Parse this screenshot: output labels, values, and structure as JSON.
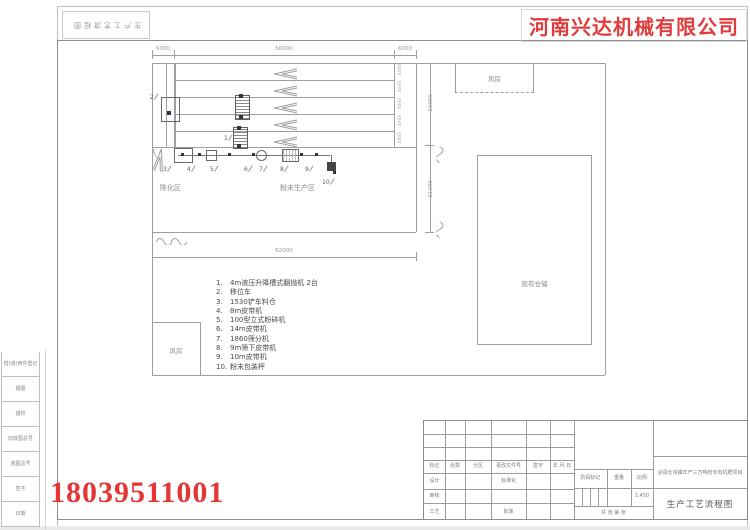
{
  "company": {
    "name": "河南兴达机械有限公司",
    "accent_color": "#e23b3b"
  },
  "watermark_phone": "18039511001",
  "top_stamp": "生产工艺流程图",
  "margin_labels": [
    "借(通)用件登记",
    "描图",
    "描校",
    "旧底图总号",
    "底图总号",
    "签字",
    "日期"
  ],
  "plan": {
    "dims": {
      "top_left": "6000",
      "top_mid": "50000",
      "top_right": "6000",
      "total_width": "62000",
      "right_upper": "21000",
      "right_lower": "21000",
      "lane": "4000"
    },
    "areas": {
      "aging": "陈化区",
      "powder": "粉末生产区",
      "fan_top": "风房",
      "fan_left": "风房",
      "storage": "现有仓储"
    },
    "lanes": [
      {
        "y": 65
      },
      {
        "y": 82
      },
      {
        "y": 99
      },
      {
        "y": 116
      },
      {
        "y": 133
      }
    ],
    "lane_dims": [
      {
        "y": 63,
        "label": "4000"
      },
      {
        "y": 80,
        "label": "4000"
      },
      {
        "y": 97,
        "label": "4000"
      },
      {
        "y": 114,
        "label": "4000"
      },
      {
        "y": 131,
        "label": "4000"
      }
    ],
    "callouts": [
      {
        "n": "1",
        "x": 224,
        "y": 135
      },
      {
        "n": "2",
        "x": 150,
        "y": 94
      },
      {
        "n": "3",
        "x": 163,
        "y": 166
      },
      {
        "n": "4",
        "x": 187,
        "y": 166
      },
      {
        "n": "5",
        "x": 210,
        "y": 166
      },
      {
        "n": "6",
        "x": 244,
        "y": 166
      },
      {
        "n": "7",
        "x": 259,
        "y": 166
      },
      {
        "n": "8",
        "x": 280,
        "y": 166
      },
      {
        "n": "9",
        "x": 305,
        "y": 166
      },
      {
        "n": "10",
        "x": 322,
        "y": 179
      }
    ]
  },
  "parts_list": [
    {
      "no": "1.",
      "text": "4m液压升降槽式翻抛机  2台"
    },
    {
      "no": "2.",
      "text": "移位车"
    },
    {
      "no": "3.",
      "text": "1530铲车料仓"
    },
    {
      "no": "4.",
      "text": "8m皮带机"
    },
    {
      "no": "5.",
      "text": "100型立式粉碎机"
    },
    {
      "no": "6.",
      "text": "14m皮带机"
    },
    {
      "no": "7.",
      "text": "1860筛分机"
    },
    {
      "no": "8.",
      "text": "9m筛下皮带机"
    },
    {
      "no": "9.",
      "text": "10m皮带机"
    },
    {
      "no": "10.",
      "text": "粉末包装秤"
    }
  ],
  "title_block": {
    "header_cells": [
      "标记",
      "处数",
      "分区",
      "更改文件号",
      "签字",
      "年.月.日"
    ],
    "design": "设计",
    "standardization": "标准化",
    "review": "审核",
    "process": "工艺",
    "approve": "批准",
    "stage_mark": "阶段标记",
    "weight": "重量",
    "scale_label": "比例",
    "scale_value": "1:450",
    "sheets_line": "共    张  第    张",
    "project": "泌县长沟镇年产三万吨粉末有机肥项目",
    "drawing_title": "生产工艺流程图"
  }
}
